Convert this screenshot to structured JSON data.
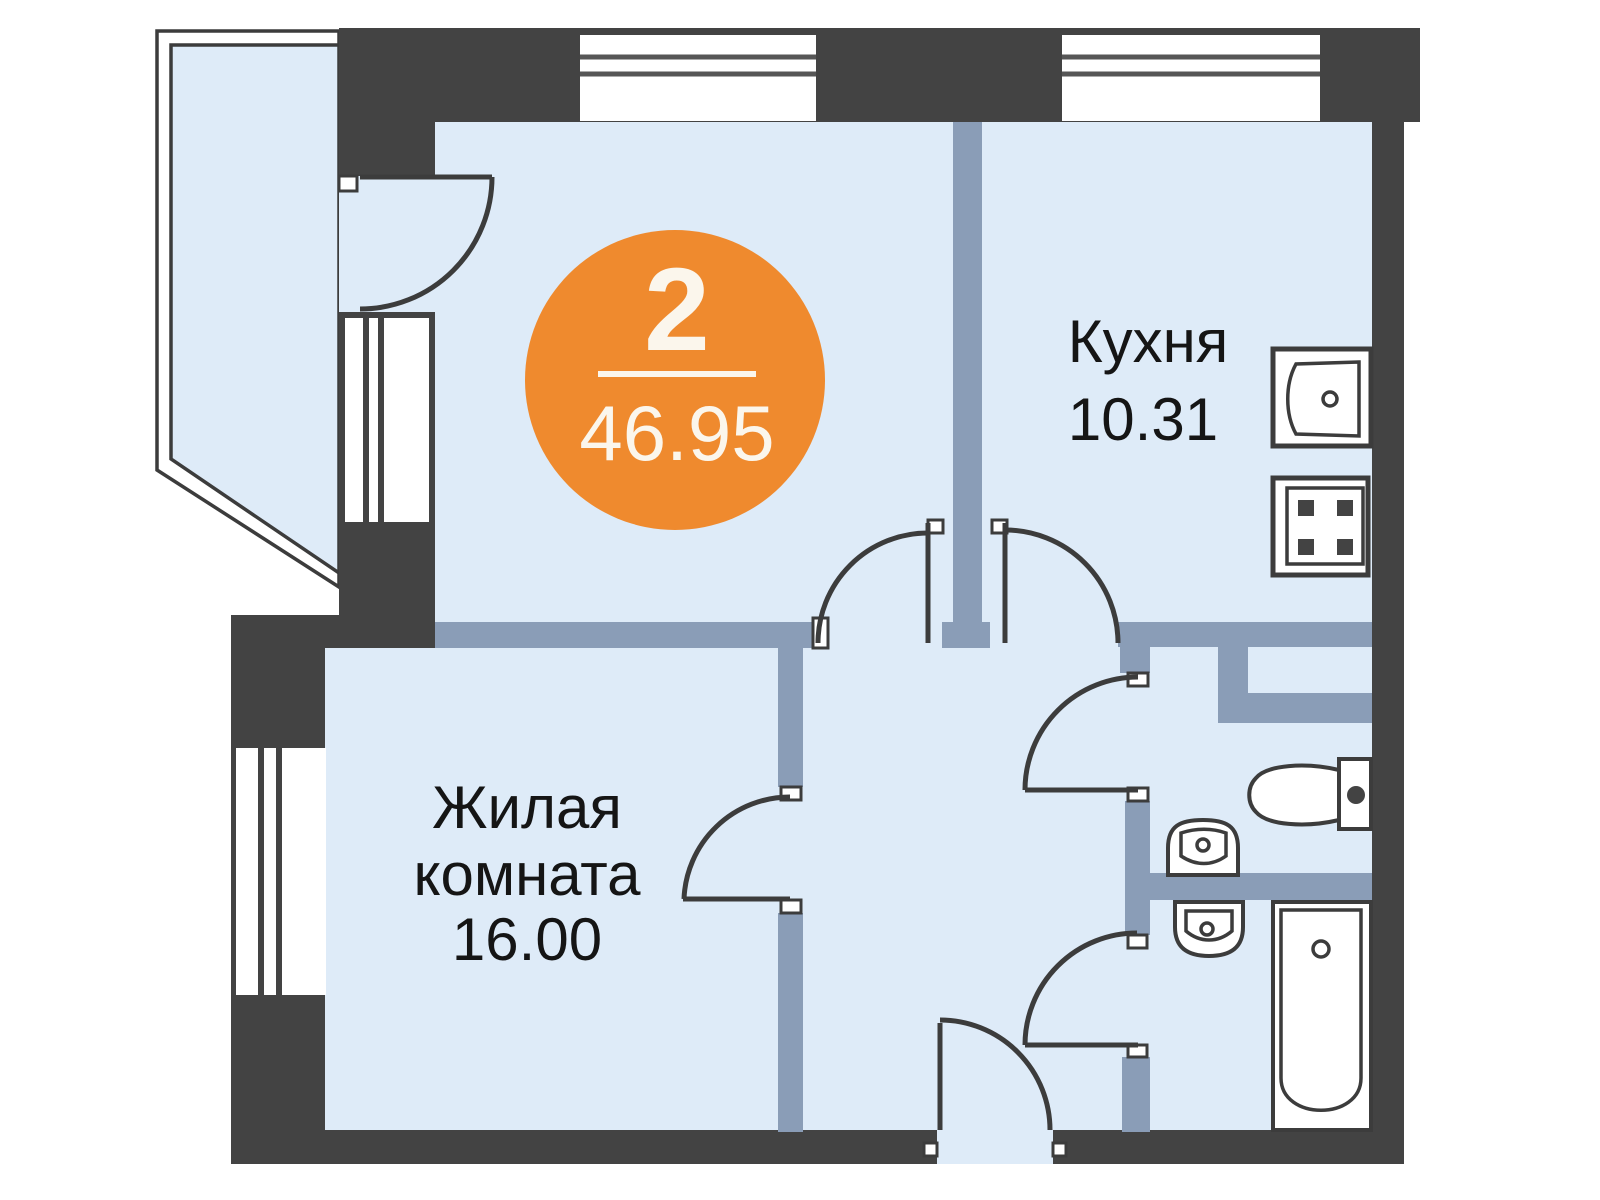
{
  "plan": {
    "badge": {
      "rooms_count": "2",
      "total_area": "46.95"
    },
    "rooms": {
      "kitchen": {
        "name": "Кухня",
        "area": "10.31"
      },
      "living_room": {
        "name_line1": "Жилая",
        "name_line2": "комната",
        "area": "16.00"
      }
    },
    "fixtures": [
      "kitchen-sink-icon",
      "stove-icon",
      "toilet-icon",
      "wash-basin-icon",
      "wash-basin-icon",
      "bathtub-icon"
    ],
    "colors": {
      "wall": "#434343",
      "room_fill": "#DEEBF8",
      "partition": "#8A9DB7",
      "accent_orange": "#EF8A2E",
      "outline": "#3C3C3C",
      "badge_text": "#FBF6EC",
      "label_text": "#151515",
      "background": "#FFFFFF"
    }
  }
}
